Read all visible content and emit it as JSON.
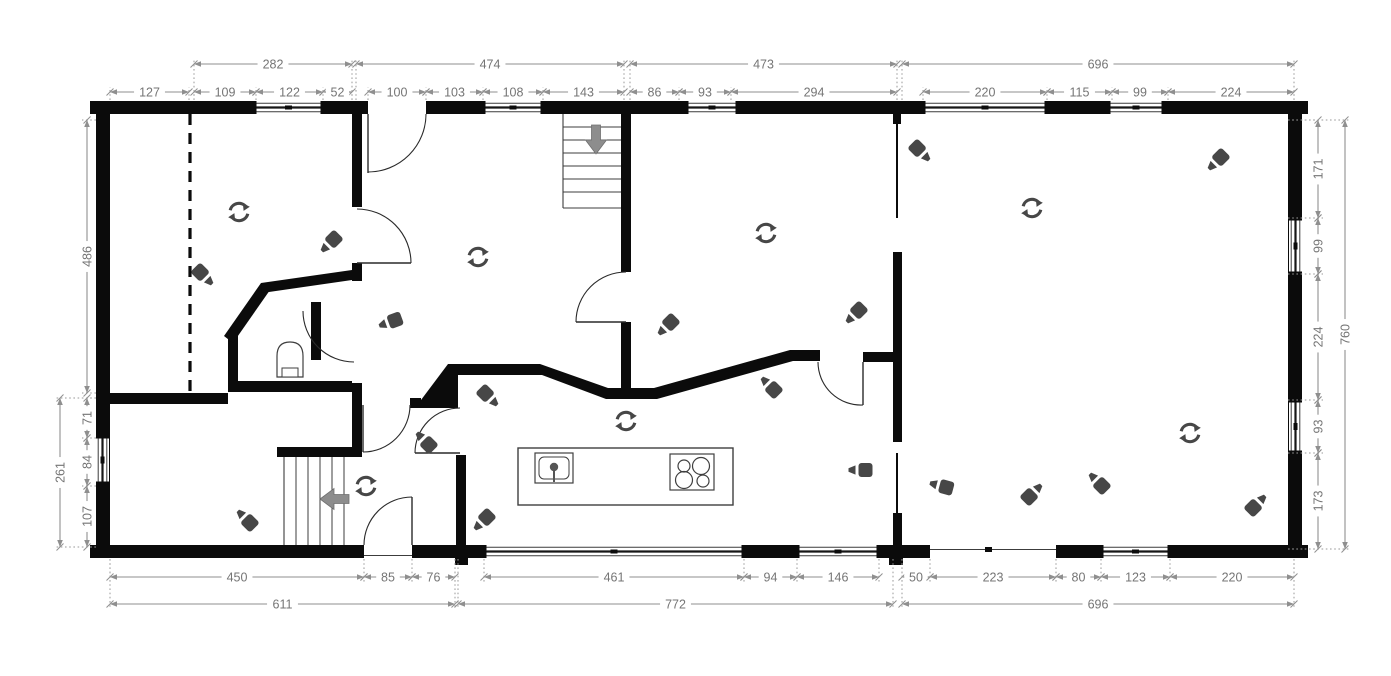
{
  "plan": {
    "canvas": {
      "width": 1391,
      "height": 676,
      "background": "#ffffff"
    },
    "colors": {
      "wall": "#0b0b0b",
      "thin_line": "#3c3c3c",
      "door": "#2a2a2a",
      "window_mid": "#161616",
      "fixture": "#3f3f3f",
      "dim_line": "#8f8f8f",
      "dim_text": "#757575",
      "witness": "#9a9a9a",
      "icon": "#474747",
      "arrow": "#8d8d8d",
      "white": "#ffffff"
    },
    "walls": {
      "exterior": [
        [
          96,
          101,
          1206,
          13
        ],
        [
          96,
          545,
          1206,
          13
        ],
        [
          96,
          101,
          14,
          457
        ],
        [
          1288,
          101,
          14,
          457
        ],
        [
          90,
          101,
          6,
          13
        ],
        [
          1302,
          101,
          6,
          13
        ],
        [
          90,
          545,
          6,
          13
        ],
        [
          1302,
          545,
          6,
          13
        ]
      ],
      "interior": [
        [
          352,
          114,
          10,
          93
        ],
        [
          352,
          263,
          10,
          18
        ],
        [
          621,
          114,
          10,
          158
        ],
        [
          621,
          322,
          10,
          68
        ],
        [
          893,
          252,
          9,
          190
        ],
        [
          893,
          513,
          9,
          32
        ],
        [
          863,
          352,
          32,
          10
        ],
        [
          893,
          114,
          8,
          10
        ],
        [
          96,
          393,
          132,
          11
        ],
        [
          228,
          334,
          10,
          58
        ],
        [
          228,
          381,
          124,
          11
        ],
        [
          311,
          302,
          10,
          58
        ],
        [
          352,
          383,
          10,
          74
        ],
        [
          277,
          447,
          85,
          10
        ],
        [
          410,
          398,
          11,
          10
        ],
        [
          456,
          455,
          10,
          90
        ],
        [
          455,
          558,
          13,
          7
        ],
        [
          889,
          558,
          14,
          7
        ]
      ],
      "thin": [
        [
          896,
          114,
          2,
          104
        ],
        [
          896,
          453,
          2,
          60
        ]
      ],
      "polygons": [
        "224,336 261,283 270,290 233,343",
        "261,283 352,270 352,280 262,293",
        "415,408 448,364 458,364 458,408",
        "458,364 540,364 608,388 654,388 790,350 820,350 820,361 793,361 657,399 606,399 542,375 458,375"
      ],
      "dashed": [
        [
          190,
          114,
          190,
          393
        ]
      ]
    },
    "openings": [
      [
        368,
        100,
        58,
        15
      ],
      [
        364,
        544,
        48,
        15
      ],
      [
        930,
        544,
        126,
        15
      ]
    ],
    "opening_lines": [
      [
        930,
        549.5,
        1056,
        549.5
      ],
      [
        364,
        555.5,
        412,
        555.5
      ]
    ],
    "opening_ticks": [
      [
        985,
        547,
        7,
        5
      ]
    ],
    "windows": [
      {
        "side": "top",
        "a": 254,
        "b": 323
      },
      {
        "side": "top",
        "a": 483,
        "b": 543
      },
      {
        "side": "top",
        "a": 686,
        "b": 738
      },
      {
        "side": "top",
        "a": 923,
        "b": 1047
      },
      {
        "side": "top",
        "a": 1108,
        "b": 1164
      },
      {
        "side": "left",
        "a": 436,
        "b": 484
      },
      {
        "side": "right",
        "a": 218,
        "b": 274
      },
      {
        "side": "right",
        "a": 400,
        "b": 453
      },
      {
        "side": "bottom",
        "a": 484,
        "b": 744
      },
      {
        "side": "bottom",
        "a": 797,
        "b": 879
      },
      {
        "side": "bottom",
        "a": 1101,
        "b": 1170
      }
    ],
    "doors": [
      {
        "leaf": [
          368,
          114,
          368,
          173
        ],
        "arc": "M 426 114 A 58 58 0 0 1 368 172"
      },
      {
        "leaf": [
          576,
          322,
          626,
          322
        ],
        "arc": "M 626 272 A 50 50 0 0 0 576 322"
      },
      {
        "leaf": [
          357,
          263,
          411,
          263
        ],
        "arc": "M 411 263 A 54 54 0 0 0 357 209"
      },
      {
        "arc": "M 303 311 A 51 51 0 0 0 354 362"
      },
      {
        "leaf": [
          363,
          405,
          363,
          452
        ],
        "arc": "M 363 452 A 47 47 0 0 0 410 405"
      },
      {
        "leaf": [
          415,
          453,
          460,
          453
        ],
        "arc": "M 415 453 A 45 45 0 0 1 460 408"
      },
      {
        "leaf": [
          412,
          497,
          412,
          545
        ],
        "arc": "M 364 545 A 48 48 0 0 1 412 497"
      },
      {
        "leaf": [
          863,
          362,
          863,
          405
        ],
        "arc": "M 818 362 A 43 43 0 0 0 863 405"
      }
    ],
    "stairs": [
      {
        "bounds": [
          563,
          114,
          621,
          208
        ],
        "edges": [
          "left",
          "bottom"
        ],
        "tread_axis": "h",
        "treads": [
          127,
          140,
          153,
          166,
          179,
          192
        ]
      },
      {
        "bounds": [
          284,
          457,
          352,
          545
        ],
        "edges": [
          "left"
        ],
        "tread_axis": "v",
        "treads": [
          296,
          308,
          320,
          332,
          344
        ]
      }
    ],
    "fixtures": {
      "island": [
        518,
        448,
        215,
        57
      ],
      "sink": {
        "outer": [
          535,
          453,
          38,
          30
        ],
        "inner": [
          539,
          457,
          30,
          22
        ],
        "faucet": [
          554,
          467,
          4.2
        ],
        "stem": [
          554,
          471,
          554,
          482
        ]
      },
      "cooktop": {
        "rect": [
          670,
          454,
          44,
          36
        ],
        "burners": [
          [
            684,
            466,
            6
          ],
          [
            701,
            466,
            8.5
          ],
          [
            684,
            480,
            8.5
          ],
          [
            703,
            481,
            6
          ]
        ]
      },
      "toilet": {
        "bowl": "M 277 377 L 277 356 Q 277 342 290 342 Q 303 342 303 356 L 303 377 Z",
        "tank": [
          282,
          368,
          16,
          9
        ]
      }
    },
    "icons": {
      "camera": {
        "name": "camera-icon",
        "positions": [
          [
            204,
            276,
            -135
          ],
          [
            330,
            243,
            -45
          ],
          [
            390,
            322,
            -20
          ],
          [
            489,
            397,
            -135
          ],
          [
            425,
            441,
            45
          ],
          [
            667,
            326,
            -45
          ],
          [
            855,
            314,
            -45
          ],
          [
            770,
            386,
            45
          ],
          [
            921,
            152,
            -135
          ],
          [
            1217,
            161,
            -45
          ],
          [
            941,
            486,
            15
          ],
          [
            1033,
            493,
            135
          ],
          [
            1098,
            482,
            45
          ],
          [
            1257,
            504,
            135
          ],
          [
            860,
            470,
            0
          ],
          [
            246,
            519,
            45
          ],
          [
            483,
            521,
            -45
          ]
        ]
      },
      "rotate": {
        "name": "rotate-360-icon",
        "positions": [
          [
            239,
            212
          ],
          [
            478,
            257
          ],
          [
            766,
            233
          ],
          [
            1032,
            208
          ],
          [
            626,
            421
          ],
          [
            366,
            486
          ],
          [
            1190,
            433
          ]
        ]
      },
      "stair_arrow": {
        "name": "stair-direction-arrow-icon",
        "positions": [
          [
            596,
            141,
            0
          ],
          [
            333,
            499,
            90
          ]
        ]
      }
    },
    "dimensions": {
      "rows": [
        {
          "id": "top-outer",
          "orient": "h",
          "pos": 64,
          "ext": 100,
          "items": [
            [
              "282",
              194,
              352
            ],
            [
              "474",
              356,
              624
            ],
            [
              "473",
              630,
              897
            ],
            [
              "696",
              902,
              1294
            ]
          ]
        },
        {
          "id": "top-inner",
          "orient": "h",
          "pos": 92,
          "ext": 100,
          "items": [
            [
              "127",
              110,
              189
            ],
            [
              "109",
              194,
              256
            ],
            [
              "122",
              256,
              323
            ],
            [
              "52",
              323,
              352
            ],
            [
              "100",
              368,
              426
            ],
            [
              "103",
              426,
              483
            ],
            [
              "108",
              483,
              543
            ],
            [
              "143",
              543,
              624
            ],
            [
              "86",
              630,
              679
            ],
            [
              "93",
              679,
              731
            ],
            [
              "294",
              731,
              897
            ],
            [
              "220",
              923,
              1047
            ],
            [
              "115",
              1047,
              1112
            ],
            [
              "99",
              1112,
              1168
            ],
            [
              "224",
              1168,
              1294
            ]
          ]
        },
        {
          "id": "bottom-inner",
          "orient": "h",
          "pos": 577,
          "ext": 559,
          "items": [
            [
              "450",
              110,
              364
            ],
            [
              "85",
              364,
              412
            ],
            [
              "76",
              412,
              455
            ],
            [
              "461",
              484,
              744
            ],
            [
              "94",
              744,
              797
            ],
            [
              "146",
              797,
              879
            ],
            [
              "50",
              902,
              930
            ],
            [
              "223",
              930,
              1056
            ],
            [
              "80",
              1056,
              1101
            ],
            [
              "123",
              1101,
              1170
            ],
            [
              "220",
              1170,
              1294
            ]
          ]
        },
        {
          "id": "bottom-outer",
          "orient": "h",
          "pos": 604,
          "ext": 559,
          "items": [
            [
              "611",
              110,
              455
            ],
            [
              "772",
              458,
              893
            ],
            [
              "696",
              902,
              1294
            ]
          ]
        },
        {
          "id": "left-inner",
          "orient": "v",
          "pos": 87,
          "ext": 96,
          "items": [
            [
              "486",
              120,
              393
            ],
            [
              "71",
              398,
              438
            ],
            [
              "84",
              438,
              486
            ],
            [
              "107",
              486,
              547
            ]
          ]
        },
        {
          "id": "left-outer",
          "orient": "v",
          "pos": 60,
          "ext": 96,
          "items": [
            [
              "261",
              398,
              547
            ]
          ]
        },
        {
          "id": "right-inner",
          "orient": "v",
          "pos": 1318,
          "ext": 1288,
          "items": [
            [
              "171",
              120,
              218
            ],
            [
              "99",
              218,
              274
            ],
            [
              "224",
              274,
              400
            ],
            [
              "93",
              400,
              453
            ],
            [
              "173",
              453,
              549
            ]
          ]
        },
        {
          "id": "right-outer",
          "orient": "v",
          "pos": 1345,
          "ext": 1288,
          "items": [
            [
              "760",
              120,
              549
            ]
          ]
        }
      ]
    }
  }
}
